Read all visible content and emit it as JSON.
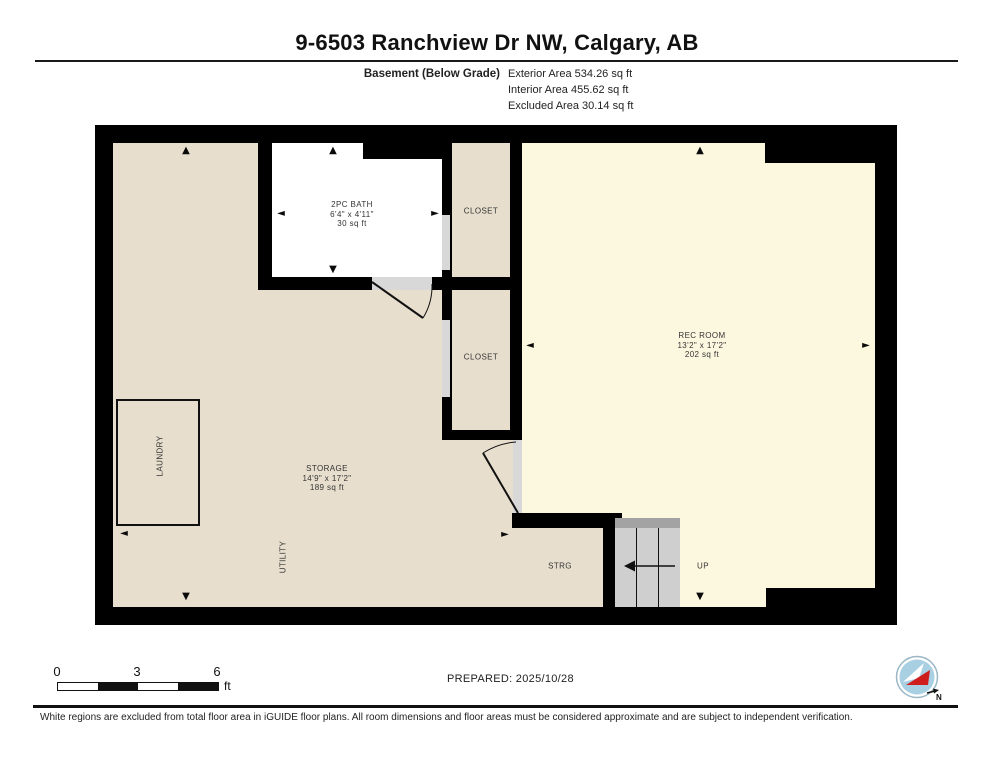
{
  "header": {
    "title": "9-6503 Ranchview Dr NW, Calgary, AB",
    "floor_label": "Basement (Below Grade)",
    "areas": [
      {
        "label": "Exterior Area",
        "value": "534.26 sq ft"
      },
      {
        "label": "Interior Area",
        "value": "455.62 sq ft"
      },
      {
        "label": "Excluded Area",
        "value": "30.14 sq ft"
      }
    ]
  },
  "rooms": {
    "bath": {
      "name": "2PC BATH",
      "dims": "6'4\" x 4'11\"",
      "area": "30 sq ft"
    },
    "closet_top": {
      "name": "CLOSET"
    },
    "closet_mid": {
      "name": "CLOSET"
    },
    "rec_room": {
      "name": "REC ROOM",
      "dims": "13'2\" x 17'2\"",
      "area": "202 sq ft"
    },
    "storage": {
      "name": "STORAGE",
      "dims": "14'9\" x 17'2\"",
      "area": "189 sq ft"
    },
    "laundry": {
      "name": "LAUNDRY"
    },
    "utility": {
      "name": "UTILITY"
    },
    "strg": {
      "name": "STRG"
    },
    "stairs": {
      "direction_label": "UP"
    }
  },
  "icons": {
    "arrow_up": "▲",
    "arrow_down": "▼",
    "arrow_left": "◄",
    "arrow_right": "►"
  },
  "scale_bar": {
    "ticks": [
      "0",
      "3",
      "6"
    ],
    "unit": "ft"
  },
  "prepared_text": "PREPARED: 2025/10/28",
  "compass": {
    "north_label": "N"
  },
  "disclaimer": "White regions are excluded from total floor area in iGUIDE floor plans. All room dimensions and floor areas must be considered approximate and are subject to independent verification.",
  "colors": {
    "wall_black": "#000000",
    "floor_tan": "#e7decd",
    "floor_cream": "#fcf7df",
    "excluded_white": "#ffffff",
    "door_gray": "#d8d8d8",
    "stairs_gray": "#cfcfcf",
    "stairs_top_gray": "#a3a3a3",
    "compass_blue": "#a9cfe3",
    "compass_red": "#cf1d1d"
  }
}
